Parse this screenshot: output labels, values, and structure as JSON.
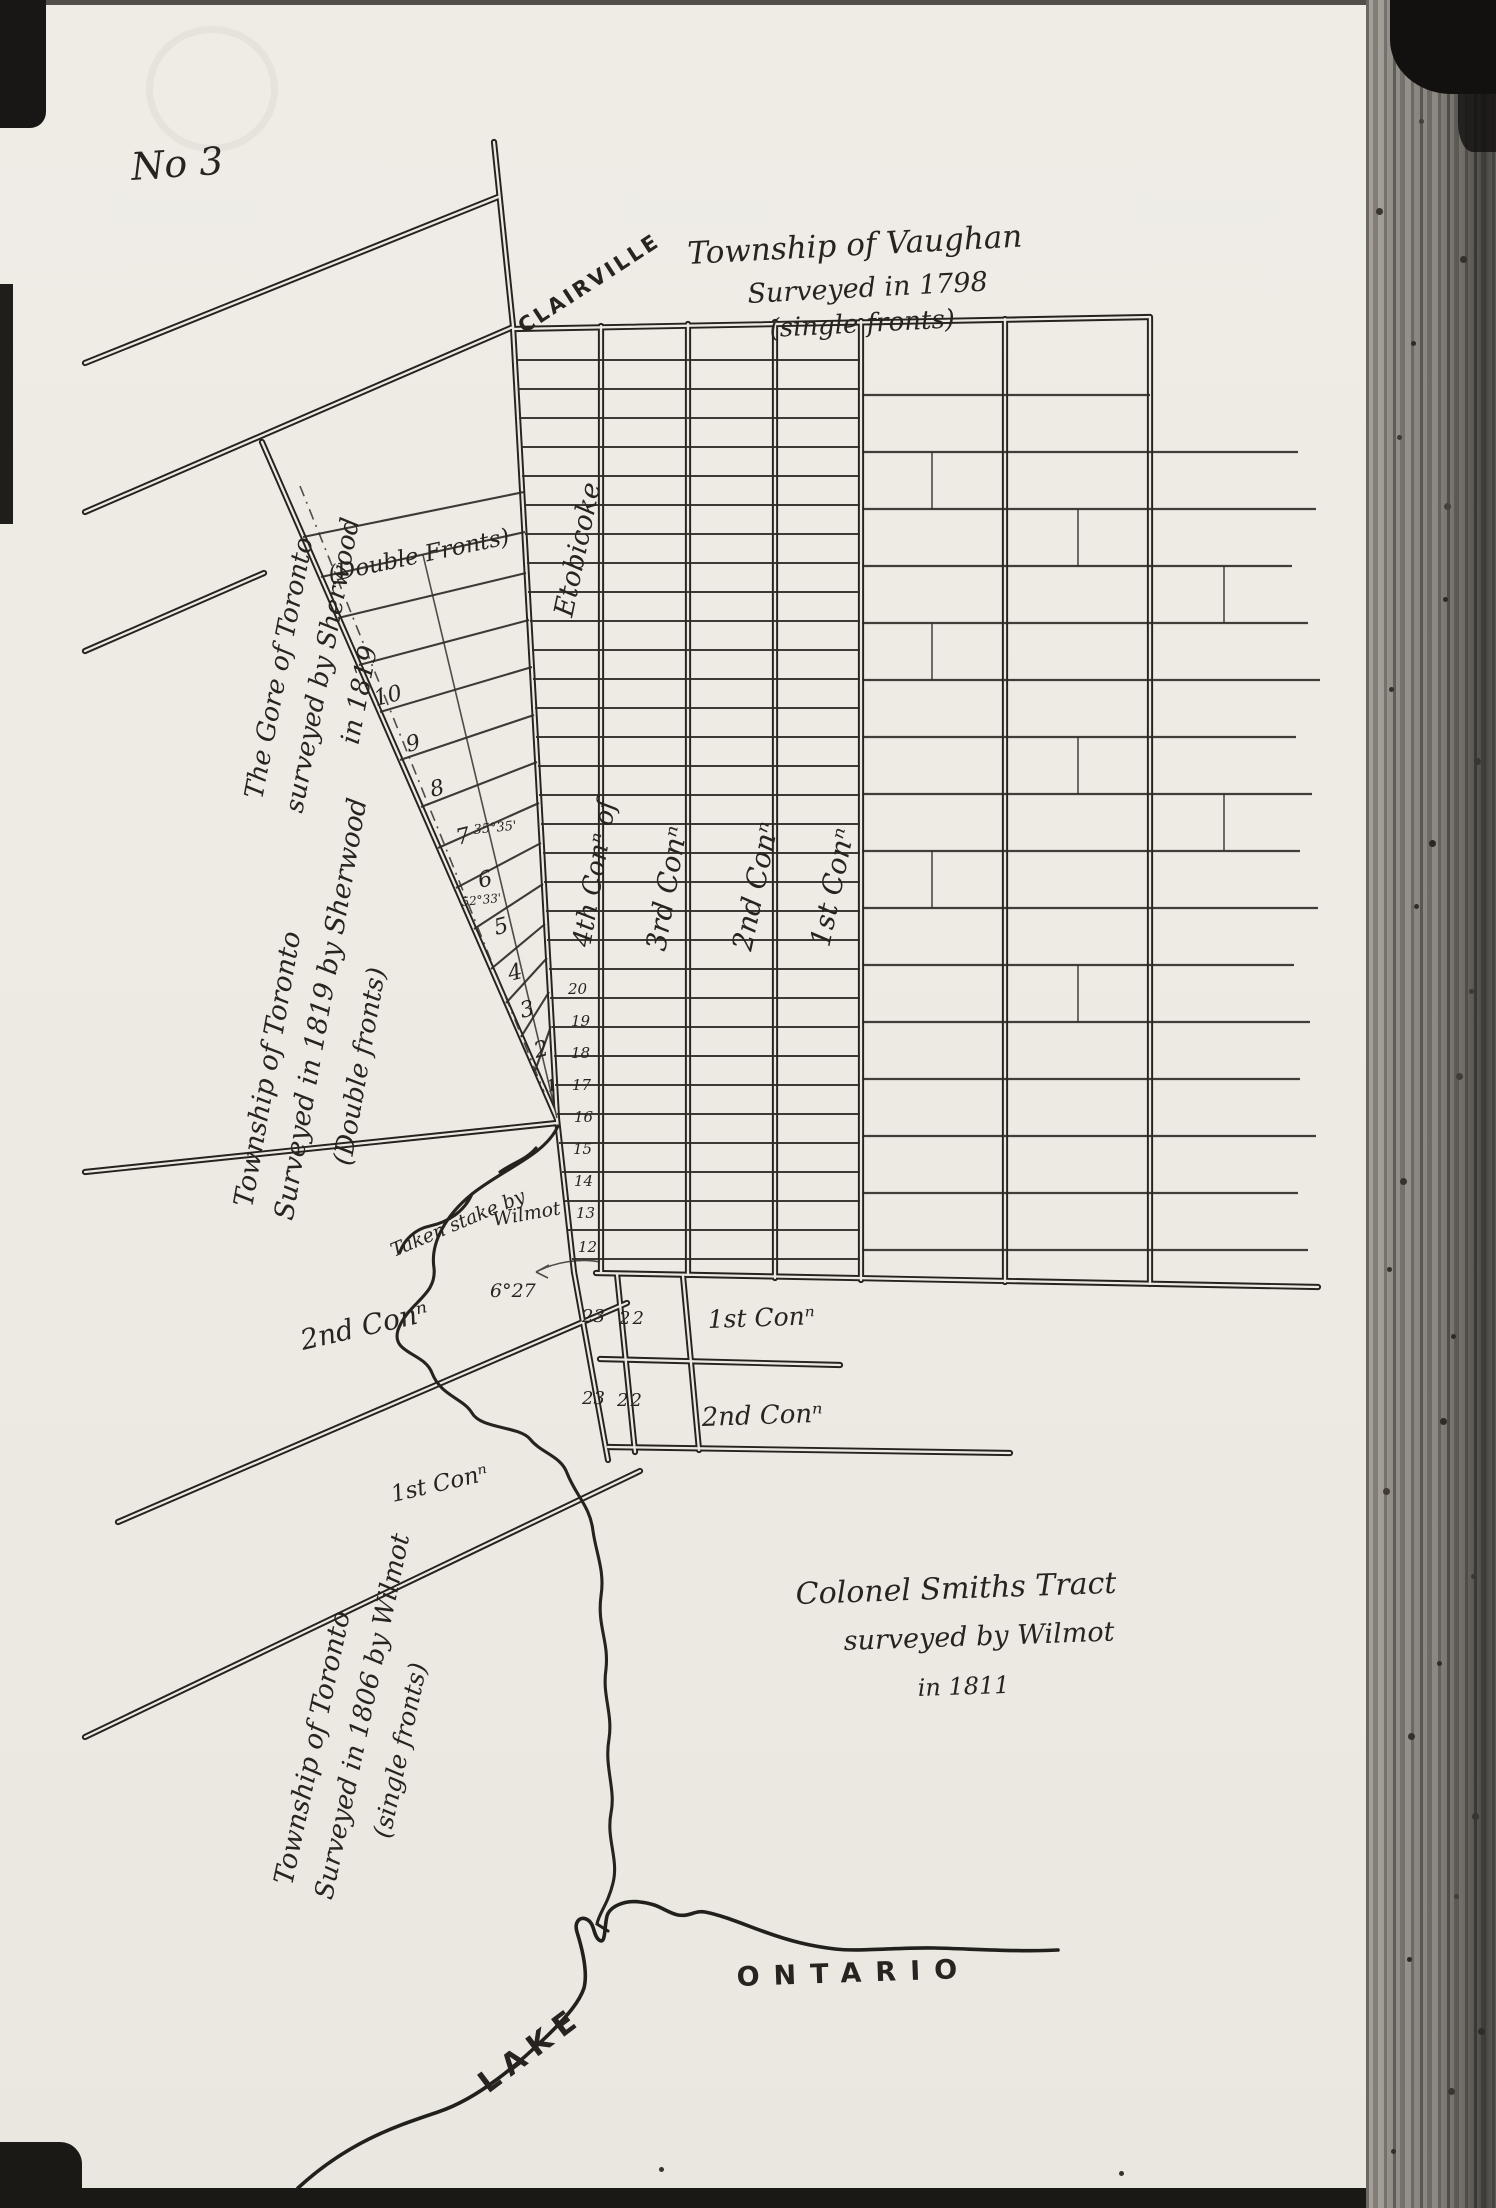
{
  "page": {
    "number_label": "No 3"
  },
  "map": {
    "ink_color": "#2a2622",
    "paper_color": "#edeae3",
    "titles": {
      "vaughan": {
        "line1": "Township of Vaughan",
        "line2": "Surveyed in 1798",
        "line3": "(single fronts)"
      },
      "gore": {
        "line1": "The Gore of Toronto",
        "line2": "surveyed by Sherwood",
        "line3": "in 1819"
      },
      "gore_fronts": "(Double Fronts)",
      "toronto1819": {
        "line1": "Township of Toronto",
        "line2": "Surveyed in 1819 by Sherwood",
        "line3": "(Double fronts)"
      },
      "toronto1806": {
        "line1": "Township of Toronto",
        "line2": "Surveyed in 1806 by Wilmot",
        "line3": "(single fronts)"
      },
      "smith": {
        "line1": "Colonel Smiths Tract",
        "line2": "surveyed by Wilmot",
        "line3": "in 1811"
      }
    },
    "places": {
      "clairville": "CLAIRVILLE",
      "etobicoke": "Etobicoke",
      "lake": "LAKE",
      "ontario": "ONTARIO"
    },
    "concessions": {
      "con4": "4th Conⁿ of",
      "con3": "3rd Conⁿ",
      "con2": "2nd Conⁿ",
      "con1": "1st Conⁿ"
    },
    "road_labels": {
      "con2_road": "2nd Conⁿ",
      "con1_road": "1st Conⁿ"
    },
    "tract_rows": {
      "row1_lot_a": "23",
      "row1_lot_b": "22",
      "row1_label": "1st Conⁿ",
      "row2_lot_a": "23",
      "row2_lot_b": "22",
      "row2_label": "2nd Conⁿ"
    },
    "wedge_lots": [
      "10",
      "9",
      "8",
      "7",
      "6",
      "5",
      "4",
      "3",
      "2",
      "1"
    ],
    "strip_lots": [
      "20",
      "19",
      "18",
      "17",
      "16",
      "15",
      "14",
      "13",
      "12"
    ],
    "annotations": {
      "angle_a": "35°35'",
      "angle_b": "52°33'",
      "angle_c": "6°27",
      "stake_line1": "Taken stake by",
      "stake_line2": "Wilmot"
    }
  }
}
